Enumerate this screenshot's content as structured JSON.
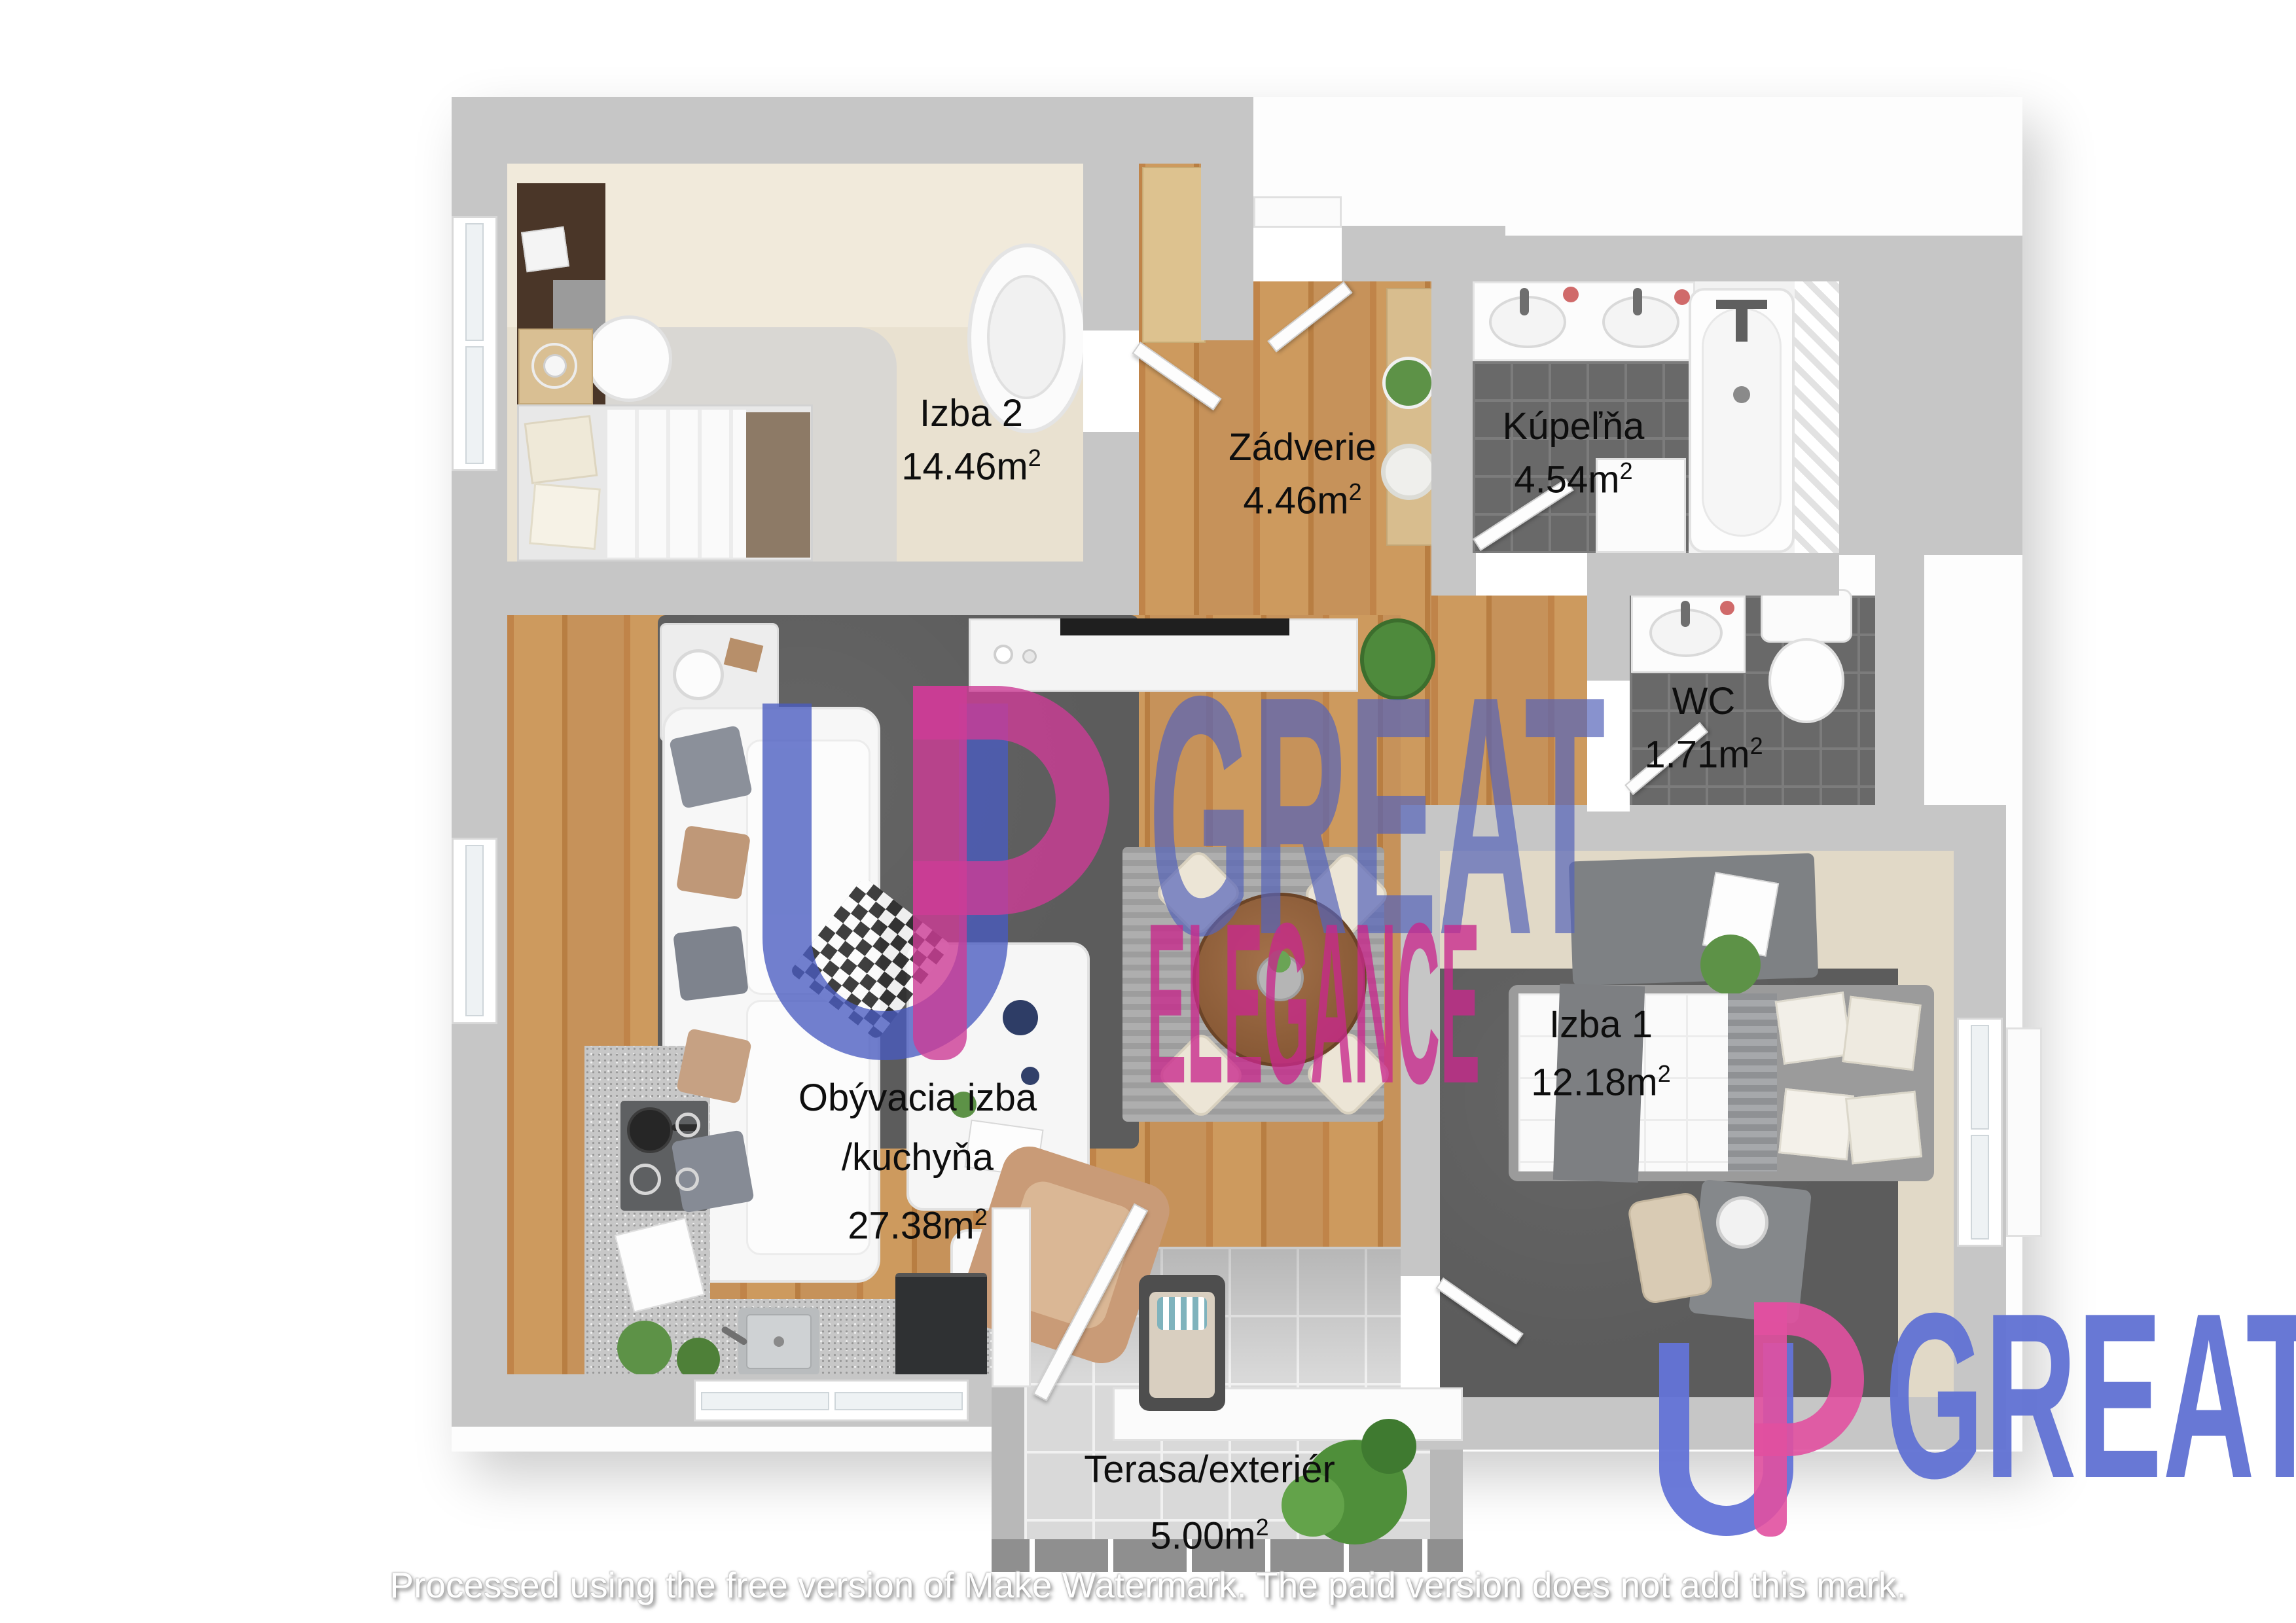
{
  "rooms": {
    "izba2": {
      "name": "Izba 2",
      "area": "14.46m",
      "exp": "2"
    },
    "zadverie": {
      "name": "Zádverie",
      "area": "4.46m",
      "exp": "2"
    },
    "kupelna": {
      "name": "Kúpeľňa",
      "area": "4.54m",
      "exp": "2"
    },
    "wc": {
      "name": "WC",
      "area": "1.71m",
      "exp": "2"
    },
    "obyvacia": {
      "name_line1": "Obývacia izba",
      "name_line2": "/kuchyňa",
      "area": "27.38m",
      "exp": "2"
    },
    "izba1": {
      "name": "Izba 1",
      "area": "12.18m",
      "exp": "2"
    },
    "terasa": {
      "name": "Terasa/exteriér",
      "area": "5.00m",
      "exp": "2"
    }
  },
  "watermark": {
    "monogram": "UP",
    "center_word": "GREAT",
    "center_sub": "ELEGANCE",
    "corner_word": "GREAT",
    "colors": {
      "blue": "#5e6fd0",
      "pink": "#d44b9d"
    }
  },
  "footer": {
    "text": "Processed using the free version of Make Watermark. The paid version does not add this mark."
  }
}
